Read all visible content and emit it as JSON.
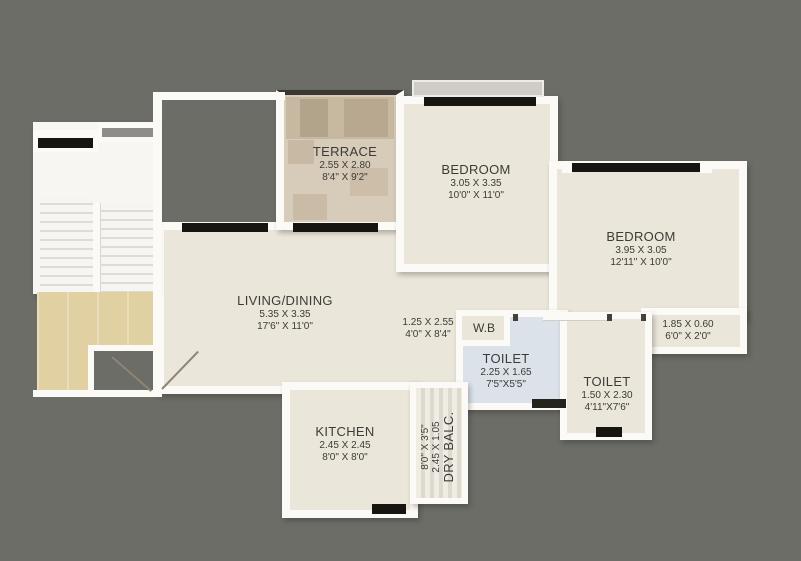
{
  "plan": {
    "colors": {
      "background": "#6c6d67",
      "wall": "#fbfaf7",
      "floor": "#eae6da",
      "terrace_floor": "#d7cbb9",
      "lobby_floor": "#e1d0a2",
      "toilet_floor": "#dbe2ea",
      "window": "#17150f",
      "text": "#3c3b36"
    },
    "rooms": [
      {
        "name": "TERRACE",
        "metric": "2.55 X 2.80",
        "imperial": "8'4\" X 9'2\""
      },
      {
        "name": "BEDROOM",
        "metric": "3.05 X 3.35",
        "imperial": "10'0\" X 11'0\""
      },
      {
        "name": "BEDROOM",
        "metric": "3.95 X 3.05",
        "imperial": "12'11\" X 10'0\""
      },
      {
        "name": "LIVING/DINING",
        "metric": "5.35 X 3.35",
        "imperial": "17'6\" X 11'0\""
      },
      {
        "name": "",
        "metric": "1.25 X 2.55",
        "imperial": "4'0\" X 8'4\""
      },
      {
        "name": "W.B",
        "metric": "",
        "imperial": ""
      },
      {
        "name": "TOILET",
        "metric": "2.25 X 1.65",
        "imperial": "7'5\"X5'5\""
      },
      {
        "name": "TOILET",
        "metric": "1.50 X 2.30",
        "imperial": "4'11\"X7'6\""
      },
      {
        "name": "",
        "metric": "1.85 X 0.60",
        "imperial": "6'0\" X 2'0\""
      },
      {
        "name": "KITCHEN",
        "metric": "2.45 X 2.45",
        "imperial": "8'0\" X 8'0\""
      },
      {
        "name": "DRY BALC.",
        "metric": "2.45 X 1.05",
        "imperial": "8'0\" X 3'5\""
      }
    ]
  }
}
